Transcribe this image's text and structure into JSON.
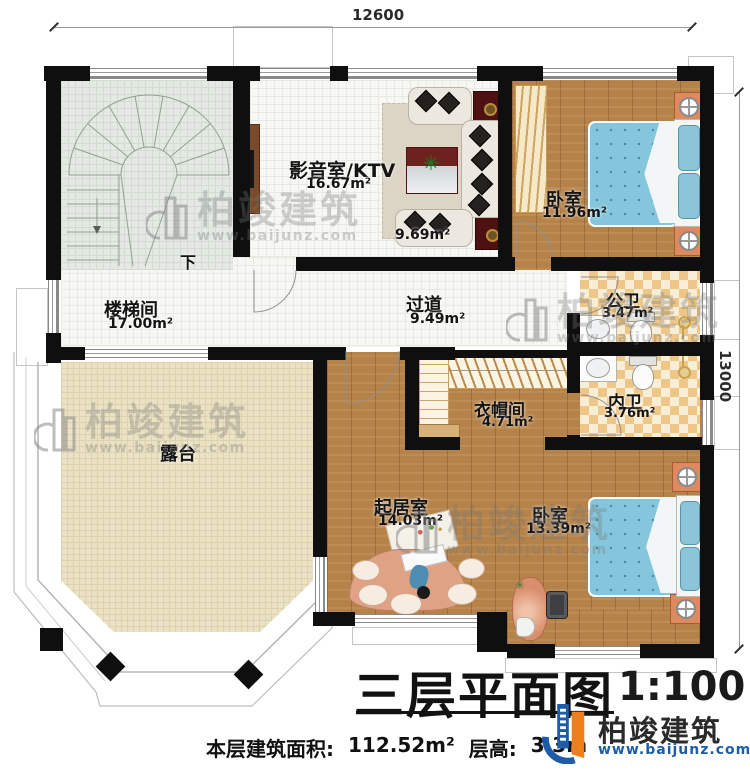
{
  "dimensions": {
    "top": "12600",
    "right": "13000"
  },
  "rooms": {
    "ktv": {
      "name": "影音室/KTV",
      "area": "16.67m²",
      "sub_area": "9.69m²"
    },
    "bedroom1": {
      "name": "卧室",
      "area": "11.96m²"
    },
    "stairwell": {
      "name": "楼梯间",
      "area": "17.00m²",
      "direction": "下"
    },
    "hallway": {
      "name": "过道",
      "area": "9.49m²"
    },
    "public_bath": {
      "name": "公卫",
      "area": "3.47m²"
    },
    "private_bath": {
      "name": "内卫",
      "area": "3.76m²"
    },
    "cloakroom": {
      "name": "衣帽间",
      "area": "4.71m²"
    },
    "terrace": {
      "name": "露台"
    },
    "living": {
      "name": "起居室",
      "area": "14.03m²"
    },
    "bedroom2": {
      "name": "卧室",
      "area": "13.39m²"
    }
  },
  "title": {
    "main": "三层平面图",
    "scale": "1:100"
  },
  "footer": {
    "area_label": "本层建筑面积:",
    "area_value": "112.52m²",
    "height_label": "层高:",
    "height_value": "3.3m"
  },
  "brand": {
    "name": "柏竣建筑",
    "url": "www.baijunz.com"
  },
  "watermark": {
    "name": "柏竣建筑",
    "url": "www.baijunz.com"
  },
  "colors": {
    "wall": "#0f0f0f",
    "wood": "#b5834a",
    "tile": "#f7f7f4",
    "stair_tile": "#e4eae3",
    "terrace": "#ebe2c6",
    "bath_checker_dark": "#eec687",
    "bath_checker_light": "#f8eed6",
    "bed": "#86c6dc",
    "nightstand": "#dd8a5f",
    "speaker": "#4e1111",
    "logo_blue": "#1d5ca8",
    "logo_orange": "#ef7f1a"
  }
}
